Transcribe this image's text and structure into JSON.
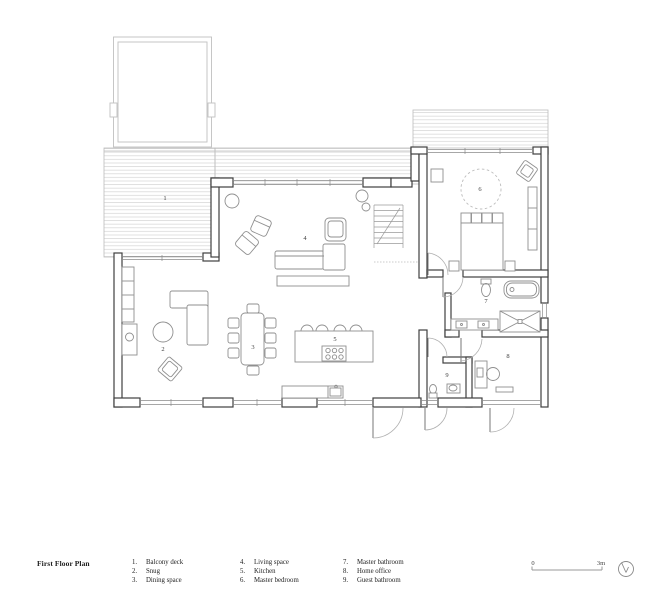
{
  "title": "First Floor Plan",
  "legend": {
    "columns": [
      {
        "items": [
          {
            "num": "1.",
            "label": "Balcony deck"
          },
          {
            "num": "2.",
            "label": "Snug"
          },
          {
            "num": "3.",
            "label": "Dining space"
          }
        ]
      },
      {
        "items": [
          {
            "num": "4.",
            "label": "Living space"
          },
          {
            "num": "5.",
            "label": "Kitchen"
          },
          {
            "num": "6.",
            "label": "Master bedroom"
          }
        ]
      },
      {
        "items": [
          {
            "num": "7.",
            "label": "Master bathroom"
          },
          {
            "num": "8.",
            "label": "Home office"
          },
          {
            "num": "9.",
            "label": "Guest bathroom"
          }
        ]
      }
    ]
  },
  "plan_labels": {
    "balcony_deck": "1",
    "snug": "2",
    "dining_space": "3",
    "living_space": "4",
    "kitchen": "5",
    "master_bedroom": "6",
    "master_bathroom": "7",
    "home_office": "8",
    "guest_bathroom": "9"
  },
  "scale_bar": {
    "start": "0",
    "end": "3m"
  },
  "icons": {
    "north_indicator": "compass-circle"
  },
  "colors": {
    "wall": "#3f3f3f",
    "window": "#8a8a8a",
    "furniture": "#8f8f8f",
    "deck_hatch": "#d8d8d8",
    "deck_outline": "#bcbcbc",
    "text": "#3f3f3f"
  }
}
